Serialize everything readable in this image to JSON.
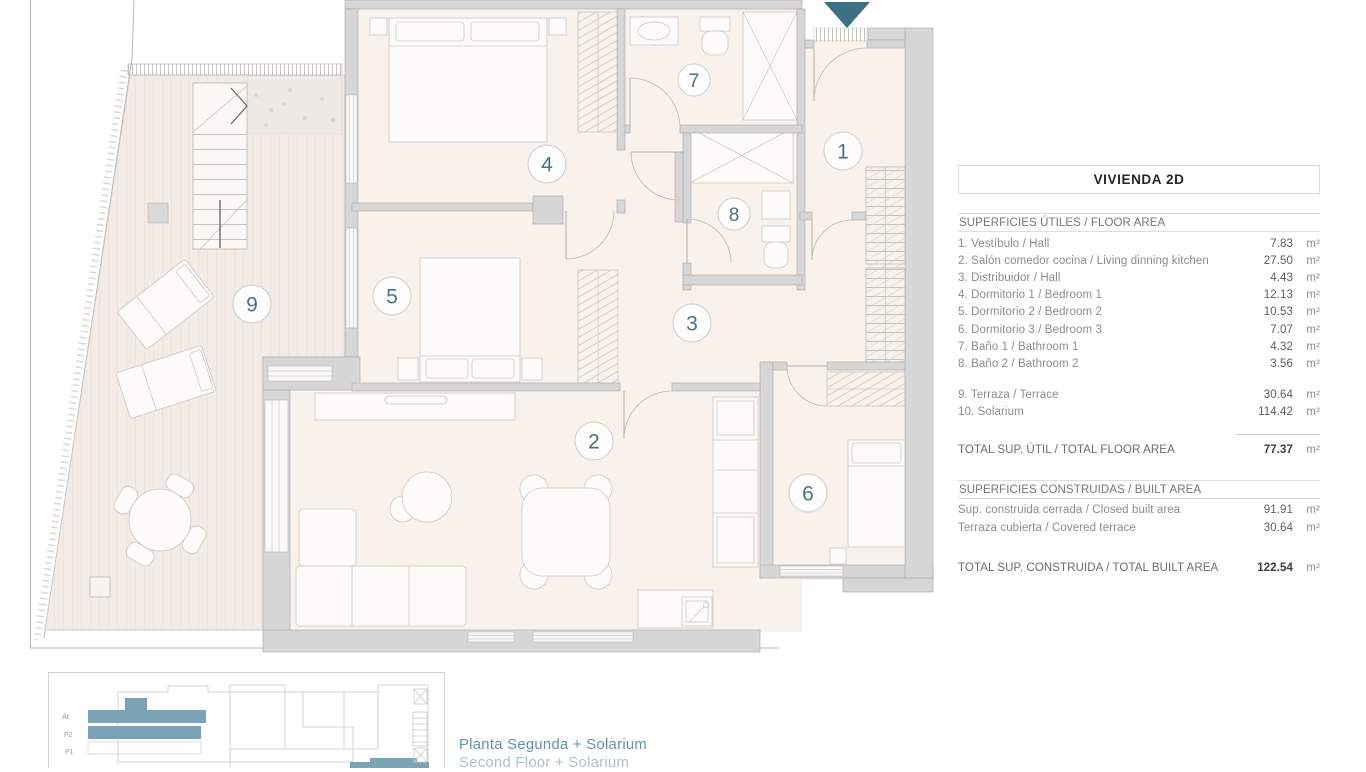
{
  "plan": {
    "rooms": {
      "r1": "1",
      "r2": "2",
      "r3": "3",
      "r4": "4",
      "r5": "5",
      "r6": "6",
      "r7": "7",
      "r8": "8",
      "r9": "9"
    }
  },
  "panel": {
    "title": "VIVIENDA 2D",
    "useful": {
      "header": "SUPERFICIES ÚTILES / FLOOR AREA",
      "rows": [
        {
          "label": "1. Vestíbulo / Hall",
          "value": "7.83",
          "unit": "m²"
        },
        {
          "label": "2. Salón comedor cocina / Living dinning kitchen",
          "value": "27.50",
          "unit": "m²"
        },
        {
          "label": "3. Distribuidor / Hall",
          "value": "4.43",
          "unit": "m²"
        },
        {
          "label": "4. Dormitorio 1 / Bedroom 1",
          "value": "12.13",
          "unit": "m²"
        },
        {
          "label": "5. Dormitorio 2 / Bedroom 2",
          "value": "10.53",
          "unit": "m²"
        },
        {
          "label": "6. Dormitorio 3 / Bedroom 3",
          "value": "7.07",
          "unit": "m²"
        },
        {
          "label": "7. Baño 1 / Bathroom 1",
          "value": "4.32",
          "unit": "m²"
        },
        {
          "label": "8. Baño 2 / Bathroom 2",
          "value": "3.56",
          "unit": "m²"
        }
      ],
      "outdoor_rows": [
        {
          "label": "9. Terraza / Terrace",
          "value": "30.64",
          "unit": "m²"
        },
        {
          "label": "10. Solarium",
          "value": "114.42",
          "unit": "m²"
        }
      ],
      "total_label": "TOTAL SUP. ÚTIL / TOTAL FLOOR AREA",
      "total_value": "77.37",
      "total_unit": "m²"
    },
    "built": {
      "header": "SUPERFICIES CONSTRUIDAS / BUILT AREA",
      "rows": [
        {
          "label": "Sup. construida cerrada / Closed built area",
          "value": "91.91",
          "unit": "m²"
        },
        {
          "label": "Terraza cubierta / Covered terrace",
          "value": "30.64",
          "unit": "m²"
        }
      ],
      "total_label": "TOTAL SUP. CONSTRUIDA /  TOTAL BUILT AREA",
      "total_value": "122.54",
      "total_unit": "m²"
    }
  },
  "legend": {
    "caption_es": "Planta Segunda + Solarium",
    "caption_en": "Second Floor + Solarium",
    "floors": {
      "attic": "Át.",
      "p2": "P2",
      "p1": "P1"
    }
  },
  "colors": {
    "accent_teal": "#3d7085",
    "highlight_blue": "#7ba3b6"
  }
}
